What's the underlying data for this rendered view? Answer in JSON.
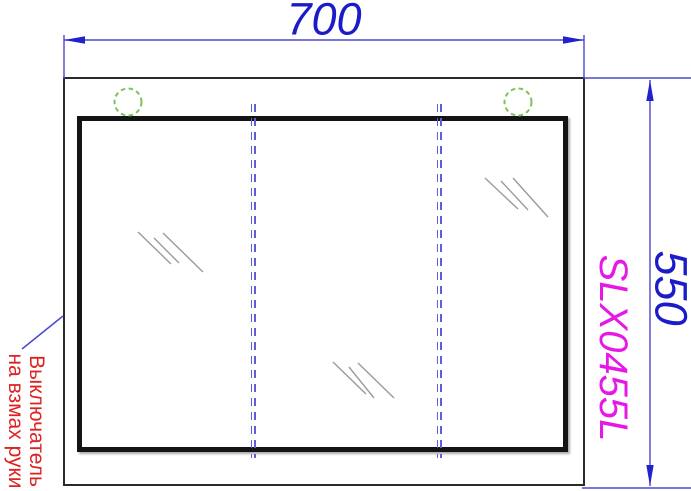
{
  "drawing": {
    "title": "Mirror cabinet technical drawing",
    "dimensions": {
      "width": {
        "value": "700"
      },
      "height": {
        "value": "550"
      }
    },
    "product": {
      "code": "SLX0455L"
    },
    "callout": {
      "line1": "Выключатель",
      "line2": "на взмах руки"
    },
    "colors": {
      "dimension_text": "#1b1bc9",
      "dimension_line": "#4a4ace",
      "product_code": "#e518e5",
      "callout_text": "#dd2222",
      "light_marker": "#7cc356",
      "split_line": "#5e5ed6",
      "frame": "#141414",
      "glint": "#9b9b9b"
    }
  }
}
